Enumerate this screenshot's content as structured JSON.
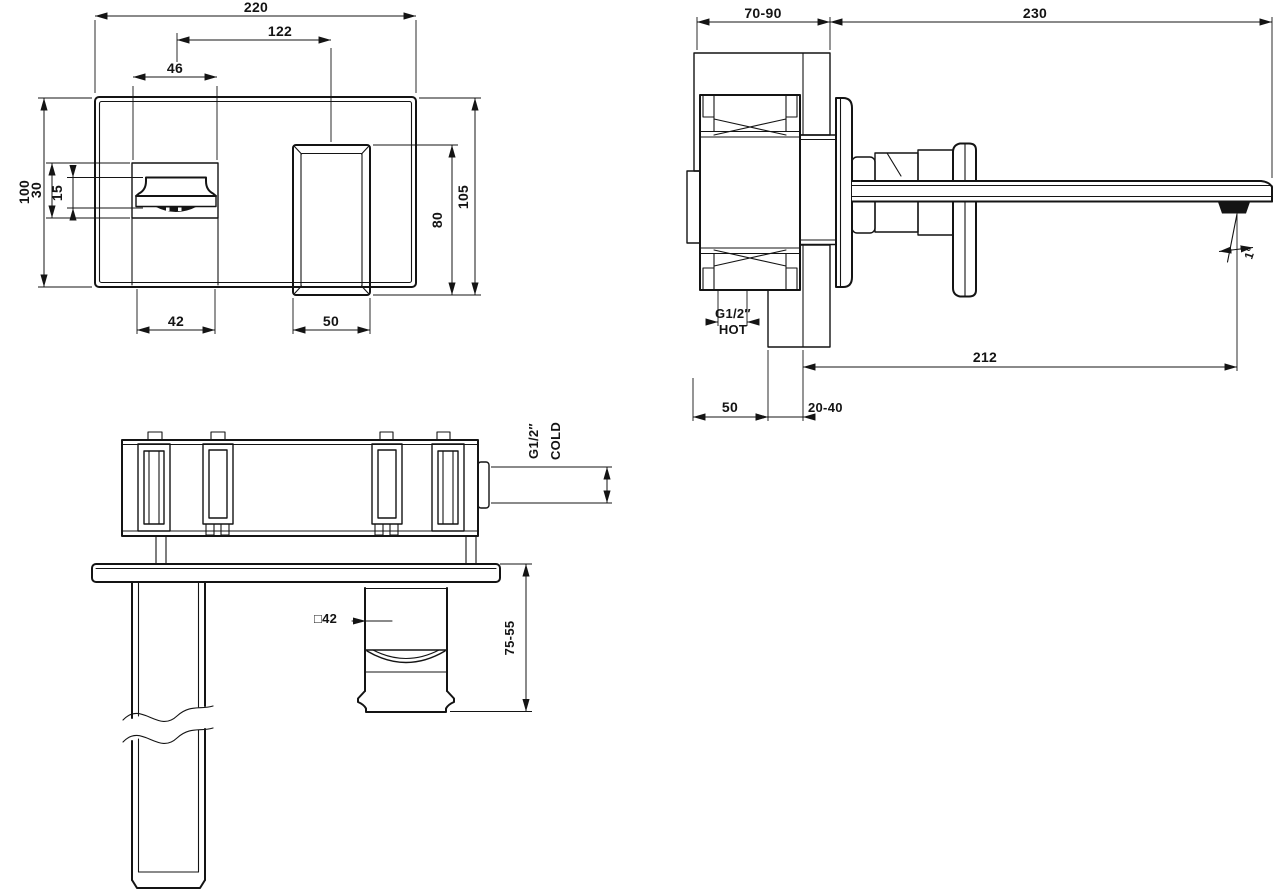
{
  "front_view": {
    "dims": {
      "overall_width": "220",
      "centers_distance": "122",
      "recess_width": "46",
      "plate_height": "100",
      "recess_height": "30",
      "spout_face_height": "15",
      "spout_width": "42",
      "handle_width": "50",
      "handle_height": "80",
      "overall_height": "105"
    }
  },
  "side_view": {
    "dims": {
      "wall_depth_range": "70-90",
      "spout_length": "230",
      "hot_thread": "G1/2″",
      "hot_label": "HOT",
      "spout_projection": "212",
      "rough_in_depth": "50",
      "finished_wall_range": "20-40",
      "spout_angle": "1°"
    }
  },
  "bottom_view": {
    "dims": {
      "cold_thread": "G1/2″",
      "cold_label": "COLD",
      "handle_square": "□42",
      "spout_drop_range": "75-55"
    }
  }
}
